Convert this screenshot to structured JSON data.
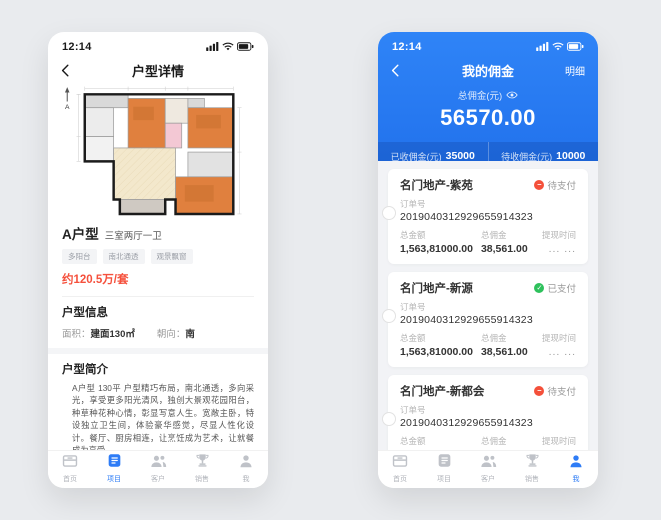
{
  "colors": {
    "accent_blue": "#2E7CF6",
    "header_blue": "#2377F2",
    "price_red": "#F5503C",
    "pending_orange": "#F4503A",
    "paid_green": "#2EC15C"
  },
  "tabbar": {
    "items": [
      {
        "label": "首页"
      },
      {
        "label": "项目"
      },
      {
        "label": "客户"
      },
      {
        "label": "销售"
      },
      {
        "label": "我"
      }
    ]
  },
  "left_phone": {
    "time": "12:14",
    "nav_title": "户型详情",
    "floorplan_compass": "A",
    "unit_name": "A户型",
    "unit_subtitle": "三室两厅一卫",
    "tags": [
      "多阳台",
      "南北通透",
      "观景飘窗"
    ],
    "price": "约120.5万/套",
    "info_title": "户型信息",
    "area_label": "面积：",
    "area_value": "建面130㎡",
    "facing_label": "朝向：",
    "facing_value": "南",
    "intro_title": "户型简介",
    "intro_text": "A户型 130平 户型精巧布局，南北通透，多向采光，享受更多阳光清风，独创大景观花园阳台，种草种花种心情，彰显写意人生。宽敞主卧，特设独立卫生间，体验豪华感觉，尽显人性化设计。餐厅、厨房相连，让烹饪成为艺术，让就餐成为享受。",
    "commission_title": "佣金",
    "badge": "TIME",
    "dropdown_text": "3月—4月佣金类型",
    "type_label": "佣金类型：",
    "type_value": "固定",
    "fee_label": "佣金：",
    "fee_value": "5000/元"
  },
  "right_phone": {
    "time": "12:14",
    "nav_title": "我的佣金",
    "nav_action": "明细",
    "total_label": "总佣金(元)",
    "total_value": "56570.00",
    "received_label": "已收佣金(元)",
    "received_value": "35000",
    "pending_label": "待收佣金(元)",
    "pending_value": "10000",
    "orders": [
      {
        "title": "名门地产-紫苑",
        "status": "待支付",
        "status_type": "pending",
        "order_label": "订单号",
        "order_no": "2019040312929655914323",
        "amount_label": "总金额",
        "amount": "1,563,81000.00",
        "commission_label": "总佣金",
        "commission": "38,561.00",
        "time_label": "提现时间",
        "time_value": "... ..."
      },
      {
        "title": "名门地产-新源",
        "status": "已支付",
        "status_type": "paid",
        "order_label": "订单号",
        "order_no": "2019040312929655914323",
        "amount_label": "总金额",
        "amount": "1,563,81000.00",
        "commission_label": "总佣金",
        "commission": "38,561.00",
        "time_label": "提现时间",
        "time_value": "... ..."
      },
      {
        "title": "名门地产-新都会",
        "status": "待支付",
        "status_type": "pending",
        "order_label": "订单号",
        "order_no": "2019040312929655914323",
        "amount_label": "总金额",
        "amount": "1,563,81000.00",
        "commission_label": "总佣金",
        "commission": "38,561.00",
        "time_label": "提现时间",
        "time_value": "... ..."
      }
    ]
  }
}
